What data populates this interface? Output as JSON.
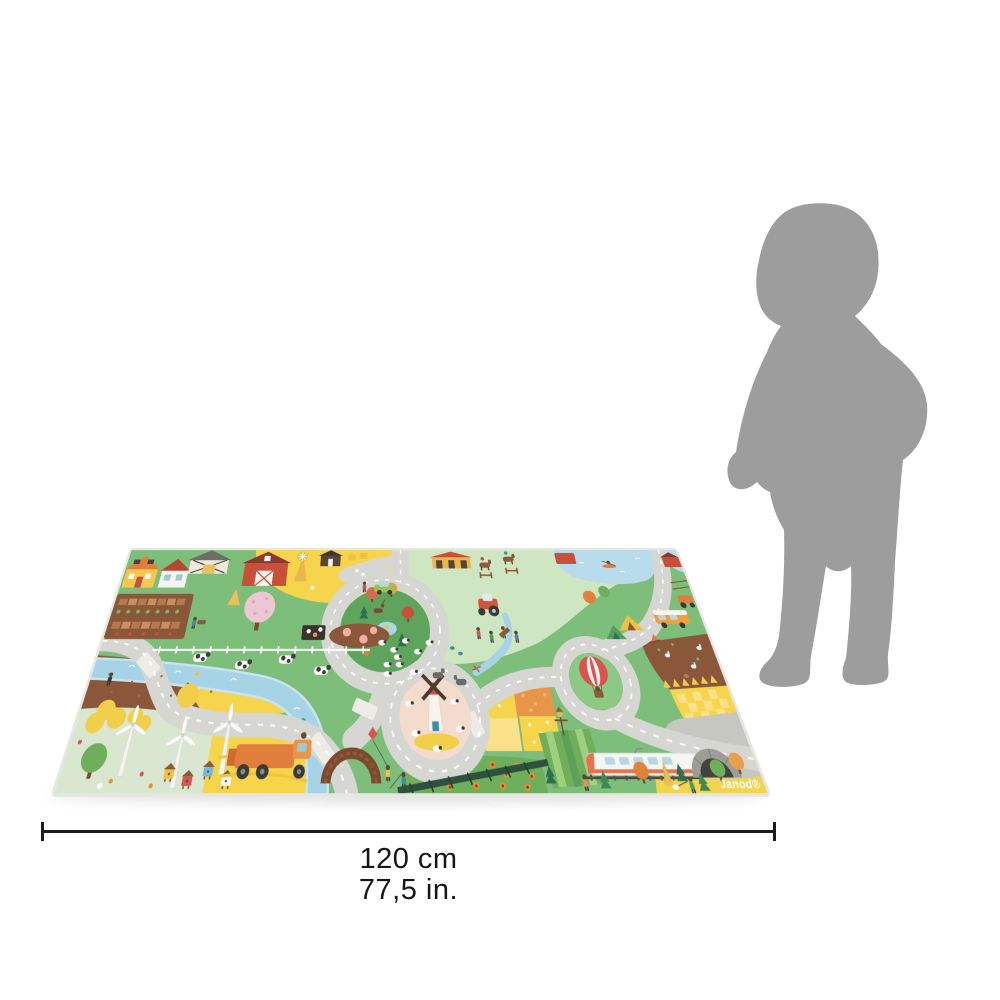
{
  "page": {
    "background": "#ffffff"
  },
  "product": {
    "brand_logo_text": "Janod®",
    "description": "Janod village and farm childrens road play mat, shown in perspective",
    "scene_elements": [
      "yellow-house",
      "white-house",
      "hay-shelter",
      "red-barn",
      "derrick-windmill",
      "dark-hut",
      "vegetable-garden",
      "orchard-tree",
      "haystack",
      "rabbit-hutch",
      "pig-pen",
      "white-fence",
      "cows",
      "sheep-flock",
      "gray-road-loop",
      "road-network",
      "white-dashed-lines",
      "pedestrian-crossings",
      "river",
      "stream",
      "wooden-arch-bridge",
      "children-fishing",
      "kite-child",
      "forest-roundabout",
      "deer",
      "fox",
      "pine-trees",
      "round-trees",
      "horse-riding-area",
      "stable",
      "horses",
      "red-tractor",
      "hikers",
      "donkeys",
      "brown-field",
      "yellow-trefoil-trees",
      "farmer",
      "wind-turbines",
      "beehives",
      "small-tree",
      "harvester-truck",
      "yellow-field",
      "windmill",
      "sheep-ring",
      "hot-air-balloon",
      "patchwork-fields",
      "scarecrow",
      "vegetable-rows",
      "sunflower-field",
      "railway-fence",
      "lake",
      "kayak",
      "fishing-deck",
      "lily-pond",
      "camper-van",
      "tents",
      "campfire",
      "rabbit-field",
      "wheat-field",
      "train",
      "tunnel",
      "railway-track",
      "forest-edge",
      "dog-walker",
      "janod-logo"
    ],
    "colors": {
      "grass_green": "#7dbe7a",
      "pale_green": "#cfe6c2",
      "mint_strip": "#d9e7d0",
      "forest_green": "#5ea45c",
      "road_gray": "#d6d7d2",
      "road_dash": "#ffffff",
      "river_blue": "#a6d4e6",
      "lake_blue": "#b8dcec",
      "field_yellow": "#f6d44c",
      "wheat_light": "#fce18a",
      "soil_brown": "#8a573a",
      "barn_red": "#c8503a",
      "roof_orange": "#e07f3c",
      "windmill_pink": "#f4dccd",
      "balloon_red": "#d9534f",
      "train_white": "#f5f5f3",
      "tunnel_gray": "#c7c7c1",
      "mat_edge": "#e7e7e2"
    }
  },
  "scale_figure": {
    "type": "toddler-silhouette",
    "color": "#9d9d9d"
  },
  "size_indicator": {
    "width_cm": "120 cm",
    "width_in": "77,5 in.",
    "line_color": "#1c1c1c"
  }
}
